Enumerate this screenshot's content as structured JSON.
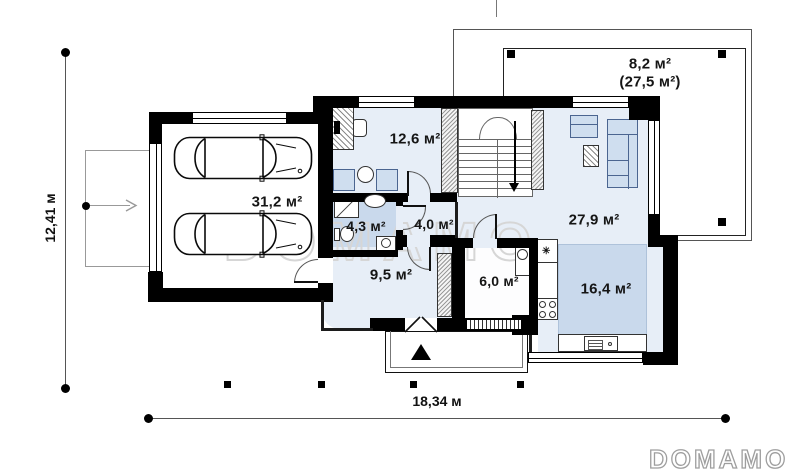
{
  "rooms": [
    {
      "id": "garage",
      "area": "31,2 м²"
    },
    {
      "id": "cabinet",
      "area": "12,6 м²"
    },
    {
      "id": "bathroom",
      "area": "4,3 м²"
    },
    {
      "id": "hall",
      "area": "4,0 м²"
    },
    {
      "id": "living-room",
      "area": "27,9 м²"
    },
    {
      "id": "entrance-hall",
      "area": "9,5 м²"
    },
    {
      "id": "pantry",
      "area": "6,0 м²"
    },
    {
      "id": "kitchen",
      "area": "16,4 м²"
    },
    {
      "id": "terrace",
      "area": "8,2 м²",
      "area_total": "(27,5 м²)"
    }
  ],
  "dimensions": {
    "overall_width": "18,34 м",
    "overall_depth": "12,41 м"
  },
  "watermark": {
    "center_text": "DОМАМО",
    "logo_text": "DOMAMO"
  },
  "icons": {
    "freezer_mark": "✳"
  },
  "colors": {
    "wall": "#000000",
    "floor": "#e7eef7",
    "wet_floor": "#c9d9ec",
    "kitchen_zone": "#c9d9ec",
    "furniture": "#cfdeef",
    "watermark": "#d6d6d6"
  }
}
